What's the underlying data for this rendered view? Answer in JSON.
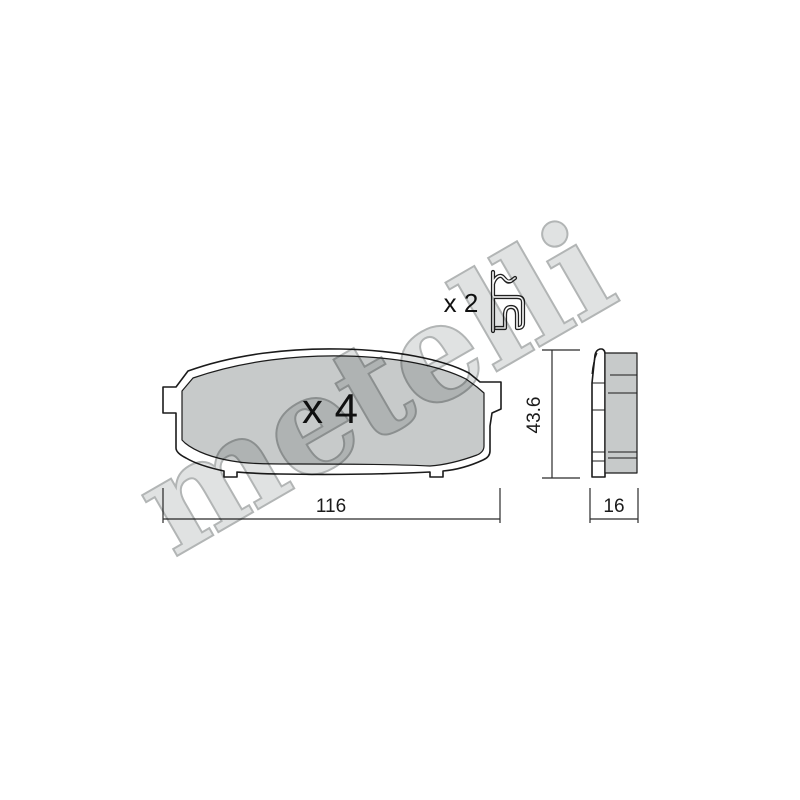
{
  "watermark": {
    "text": "metelli"
  },
  "front_view": {
    "quantity_label": "x 4",
    "width_dim": "116"
  },
  "clip": {
    "quantity_label": "x 2"
  },
  "side_view": {
    "height_dim": "43.6",
    "thickness_dim": "16"
  },
  "colors": {
    "background": "#ffffff",
    "pad_fill": "#c7caca",
    "outline": "#1b1b1b",
    "dim_line": "#2b2b2b",
    "watermark_fill": "#e0e2e2",
    "watermark_stroke": "#b2b5b5"
  }
}
